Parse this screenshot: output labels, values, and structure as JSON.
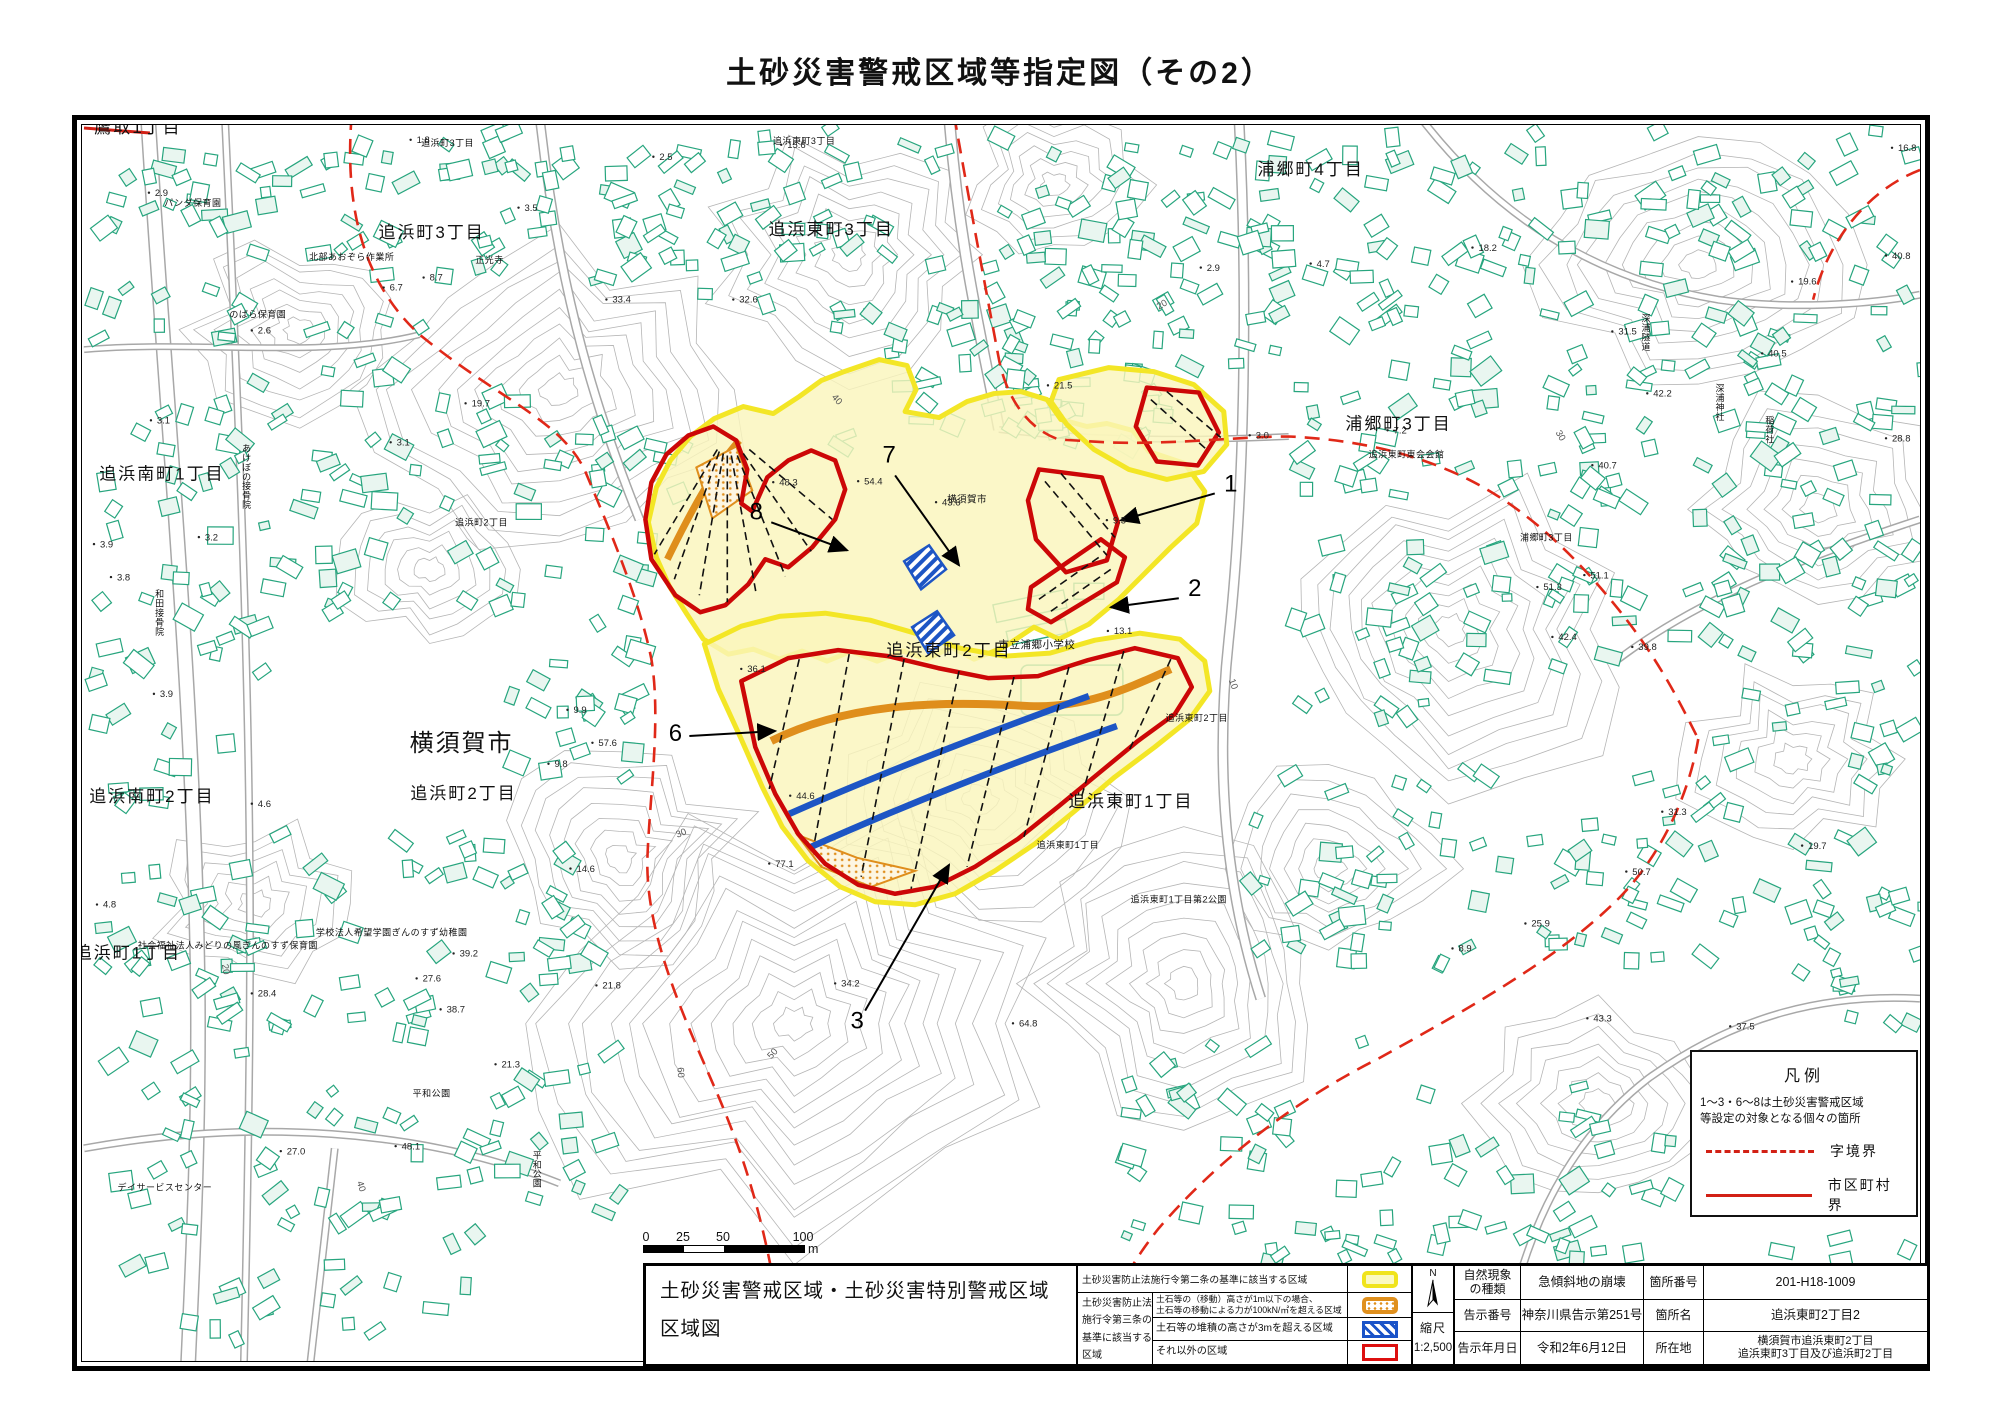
{
  "title": "土砂災害警戒区域等指定図（その2）",
  "legend_box": {
    "title": "凡例",
    "note": "1～3・6～8は土砂災害警戒区域\n等設定の対象となる個々の箇所",
    "items": [
      {
        "style": "dashed",
        "label": "字境界"
      },
      {
        "style": "solid",
        "label": "市区町村界"
      }
    ]
  },
  "scale_bar": {
    "ticks": [
      "0",
      "25",
      "50",
      "100"
    ],
    "unit": "m"
  },
  "info_table": {
    "map_title_line1": "土砂災害警戒区域・土砂災害特別警戒区域",
    "map_title_line2": "区域図",
    "legend_row1": "土砂災害防止法施行令第二条の基準に該当する区域",
    "group_label": "土砂災害防止法\n施行令第三条の\n基準に該当する\n区域",
    "sub_row1": "土石等の（移動）高さが1m以下の場合、\n土石等の移動による力が100kN/㎡を超える区域",
    "sub_row2": "土石等の堆積の高さが3mを超える区域",
    "sub_row3": "それ以外の区域",
    "north_label": "N",
    "scale_label": "縮尺",
    "scale_value": "1:2,500",
    "details": [
      {
        "k": "自然現象\nの種類",
        "v": "急傾斜地の崩壊",
        "k2": "箇所番号",
        "v2": "201-H18-1009"
      },
      {
        "k": "告示番号",
        "v": "神奈川県告示第251号",
        "k2": "箇所名",
        "v2": "追浜東町2丁目2"
      },
      {
        "k": "告示年月日",
        "v": "令和2年6月12日",
        "k2": "所在地",
        "v2": "横須賀市追浜東町2丁目\n追浜東町3丁目及び追浜町2丁目"
      }
    ]
  },
  "colors": {
    "warning_yellow_border": "#f3e626",
    "warning_yellow_fill": "#faf5bc",
    "special_red": "#cc0707",
    "debris_orange": "#df8e1c",
    "deposit_blue": "#1d55c4",
    "building_green": "#27a57e",
    "boundary_red": "#e02818",
    "contour_gray": "#b5b5b5"
  },
  "map": {
    "place_labels": [
      {
        "t": "鷹取1丁目",
        "x": 138,
        "y": 133,
        "s": 17
      },
      {
        "t": "追浜町3丁目",
        "x": 448,
        "y": 146,
        "s": 9
      },
      {
        "t": "追浜町3丁目",
        "x": 432,
        "y": 238,
        "s": 17
      },
      {
        "t": "追浜東町3丁目",
        "x": 805,
        "y": 144,
        "s": 9
      },
      {
        "t": "追浜東町3丁目",
        "x": 832,
        "y": 235,
        "s": 17
      },
      {
        "t": "浦郷町4丁目",
        "x": 1312,
        "y": 175,
        "s": 17
      },
      {
        "t": "浦郷町3丁目",
        "x": 1400,
        "y": 430,
        "s": 17
      },
      {
        "t": "浦郷町3丁目",
        "x": 1548,
        "y": 541,
        "s": 9
      },
      {
        "t": "追浜南町1丁目",
        "x": 162,
        "y": 480,
        "s": 17
      },
      {
        "t": "横須賀市",
        "x": 462,
        "y": 752,
        "s": 24
      },
      {
        "t": "追浜町2丁目",
        "x": 464,
        "y": 800,
        "s": 17
      },
      {
        "t": "追浜南町2丁目",
        "x": 152,
        "y": 803,
        "s": 17
      },
      {
        "t": "追浜東町2丁目",
        "x": 950,
        "y": 657,
        "s": 17
      },
      {
        "t": "追浜東町1丁目",
        "x": 1132,
        "y": 808,
        "s": 17
      },
      {
        "t": "追浜町1丁目",
        "x": 128,
        "y": 960,
        "s": 17
      },
      {
        "t": "市立浦郷小学校",
        "x": 1038,
        "y": 649,
        "s": 10.5
      },
      {
        "t": "横須賀市",
        "x": 968,
        "y": 503,
        "s": 9.5
      },
      {
        "t": "追浜東町2丁目",
        "x": 1198,
        "y": 722,
        "s": 9
      },
      {
        "t": "追浜町2丁目",
        "x": 482,
        "y": 526,
        "s": 9
      },
      {
        "t": "パンダ保育園",
        "x": 193,
        "y": 206,
        "s": 9
      },
      {
        "t": "北部あおぞら作業所",
        "x": 352,
        "y": 260,
        "s": 9
      },
      {
        "t": "正光寺",
        "x": 490,
        "y": 263,
        "s": 9
      },
      {
        "t": "のばら保育園",
        "x": 258,
        "y": 318,
        "s": 9
      },
      {
        "t": "追浜東町東会会館",
        "x": 1408,
        "y": 458,
        "s": 9
      },
      {
        "t": "学校法人希望学園ぎんのすず幼稚園",
        "x": 392,
        "y": 937,
        "s": 9
      },
      {
        "t": "社会福祉法人みどりの風ぎんのすず保育園",
        "x": 228,
        "y": 950,
        "s": 9
      },
      {
        "t": "追浜東町1丁目",
        "x": 1069,
        "y": 849,
        "s": 9
      },
      {
        "t": "追浜東町1丁目第2公園",
        "x": 1180,
        "y": 904,
        "s": 9
      },
      {
        "t": "平和公園",
        "x": 432,
        "y": 1098,
        "s": 9
      },
      {
        "t": "デイサービスセンター",
        "x": 165,
        "y": 1192,
        "s": 9
      },
      {
        "t": "平和公園",
        "x": 538,
        "y": 1160,
        "s": 9,
        "vert": true
      },
      {
        "t": "和田接骨院",
        "x": 160,
        "y": 598,
        "s": 9,
        "vert": true
      },
      {
        "t": "あけぼの接骨院",
        "x": 247,
        "y": 452,
        "s": 9,
        "vert": true
      },
      {
        "t": "深浦隧道",
        "x": 1648,
        "y": 322,
        "s": 9,
        "vert": true
      },
      {
        "t": "深浦神社",
        "x": 1722,
        "y": 392,
        "s": 9,
        "vert": true
      },
      {
        "t": "稲荷社",
        "x": 1772,
        "y": 424,
        "s": 9,
        "vert": true
      }
    ],
    "spot_elevations": [
      {
        "v": "2.5",
        "x": 660,
        "y": 160
      },
      {
        "v": "1.8",
        "x": 417,
        "y": 143
      },
      {
        "v": "2.9",
        "x": 155,
        "y": 196
      },
      {
        "v": "2.6",
        "x": 258,
        "y": 334
      },
      {
        "v": "3.1",
        "x": 157,
        "y": 424
      },
      {
        "v": "3.1",
        "x": 397,
        "y": 446
      },
      {
        "v": "3.2",
        "x": 205,
        "y": 541
      },
      {
        "v": "3.8",
        "x": 117,
        "y": 581
      },
      {
        "v": "3.9",
        "x": 160,
        "y": 698
      },
      {
        "v": "3.9",
        "x": 100,
        "y": 548
      },
      {
        "v": "4.6",
        "x": 258,
        "y": 808
      },
      {
        "v": "4.8",
        "x": 103,
        "y": 909
      },
      {
        "v": "8.7",
        "x": 430,
        "y": 281
      },
      {
        "v": "6.7",
        "x": 390,
        "y": 291
      },
      {
        "v": "3.5",
        "x": 525,
        "y": 211
      },
      {
        "v": "33.4",
        "x": 613,
        "y": 303
      },
      {
        "v": "32.6",
        "x": 740,
        "y": 303
      },
      {
        "v": "15.6",
        "x": 788,
        "y": 148
      },
      {
        "v": "2.9",
        "x": 1208,
        "y": 271
      },
      {
        "v": "4.7",
        "x": 1318,
        "y": 267
      },
      {
        "v": "18.2",
        "x": 1480,
        "y": 251
      },
      {
        "v": "3.0",
        "x": 1257,
        "y": 439
      },
      {
        "v": "7.2",
        "x": 1395,
        "y": 434
      },
      {
        "v": "21.5",
        "x": 1055,
        "y": 389
      },
      {
        "v": "9.5",
        "x": 1114,
        "y": 524
      },
      {
        "v": "48.3",
        "x": 780,
        "y": 486
      },
      {
        "v": "54.4",
        "x": 865,
        "y": 485
      },
      {
        "v": "43.6",
        "x": 943,
        "y": 506
      },
      {
        "v": "36.1",
        "x": 748,
        "y": 673
      },
      {
        "v": "44.6",
        "x": 797,
        "y": 800
      },
      {
        "v": "9.9",
        "x": 574,
        "y": 714
      },
      {
        "v": "9.8",
        "x": 555,
        "y": 768
      },
      {
        "v": "14.6",
        "x": 577,
        "y": 873
      },
      {
        "v": "13.1",
        "x": 1115,
        "y": 635
      },
      {
        "v": "21.8",
        "x": 603,
        "y": 990
      },
      {
        "v": "34.2",
        "x": 842,
        "y": 988
      },
      {
        "v": "64.8",
        "x": 1020,
        "y": 1028
      },
      {
        "v": "77.1",
        "x": 776,
        "y": 868
      },
      {
        "v": "57.6",
        "x": 599,
        "y": 747
      },
      {
        "v": "28.4",
        "x": 258,
        "y": 998
      },
      {
        "v": "27.6",
        "x": 423,
        "y": 983
      },
      {
        "v": "39.2",
        "x": 460,
        "y": 958
      },
      {
        "v": "38.7",
        "x": 447,
        "y": 1014
      },
      {
        "v": "21.3",
        "x": 502,
        "y": 1069
      },
      {
        "v": "27.0",
        "x": 287,
        "y": 1156
      },
      {
        "v": "48.1",
        "x": 402,
        "y": 1151
      },
      {
        "v": "16.8",
        "x": 1900,
        "y": 151
      },
      {
        "v": "40.8",
        "x": 1894,
        "y": 259
      },
      {
        "v": "19.6",
        "x": 1800,
        "y": 285
      },
      {
        "v": "31.5",
        "x": 1620,
        "y": 335
      },
      {
        "v": "40.5",
        "x": 1770,
        "y": 357
      },
      {
        "v": "42.2",
        "x": 1655,
        "y": 397
      },
      {
        "v": "40.7",
        "x": 1600,
        "y": 469
      },
      {
        "v": "28.8",
        "x": 1894,
        "y": 442
      },
      {
        "v": "51.3",
        "x": 1545,
        "y": 591
      },
      {
        "v": "51.1",
        "x": 1592,
        "y": 579
      },
      {
        "v": "42.4",
        "x": 1560,
        "y": 641
      },
      {
        "v": "39.8",
        "x": 1640,
        "y": 651
      },
      {
        "v": "31.3",
        "x": 1670,
        "y": 816
      },
      {
        "v": "50.7",
        "x": 1634,
        "y": 876
      },
      {
        "v": "43.3",
        "x": 1595,
        "y": 1023
      },
      {
        "v": "37.5",
        "x": 1738,
        "y": 1031
      },
      {
        "v": "25.9",
        "x": 1533,
        "y": 928
      },
      {
        "v": "8.9",
        "x": 1460,
        "y": 953
      },
      {
        "v": "19.7",
        "x": 1810,
        "y": 850
      },
      {
        "v": "19.7",
        "x": 472,
        "y": 407
      }
    ],
    "contour_labels": [
      {
        "v": "20",
        "x": 222,
        "y": 966,
        "r": 80
      },
      {
        "v": "40",
        "x": 357,
        "y": 1184,
        "r": 72
      },
      {
        "v": "50",
        "x": 772,
        "y": 1061,
        "r": -48
      },
      {
        "v": "60",
        "x": 678,
        "y": 1069,
        "r": 86
      },
      {
        "v": "30",
        "x": 678,
        "y": 839,
        "r": -22
      },
      {
        "v": "10",
        "x": 1230,
        "y": 681,
        "r": 70
      },
      {
        "v": "30",
        "x": 1557,
        "y": 433,
        "r": 60
      },
      {
        "v": "40",
        "x": 832,
        "y": 398,
        "r": 48
      },
      {
        "v": "20",
        "x": 1160,
        "y": 310,
        "r": -30
      }
    ],
    "site_numbers": [
      {
        "n": "1",
        "tx": 1232,
        "ty": 492,
        "sx": 1216,
        "sy": 494,
        "ax": 1122,
        "ay": 521
      },
      {
        "n": "2",
        "tx": 1196,
        "ty": 597,
        "sx": 1180,
        "sy": 599,
        "ax": 1112,
        "ay": 608
      },
      {
        "n": "3",
        "tx": 858,
        "ty": 1030,
        "sx": 866,
        "sy": 1012,
        "ax": 950,
        "ay": 866
      },
      {
        "n": "6",
        "tx": 676,
        "ty": 742,
        "sx": 690,
        "sy": 737,
        "ax": 776,
        "ay": 732
      },
      {
        "n": "7",
        "tx": 890,
        "ty": 463,
        "sx": 896,
        "sy": 476,
        "ax": 960,
        "ay": 566
      },
      {
        "n": "8",
        "tx": 757,
        "ty": 520,
        "sx": 772,
        "sy": 523,
        "ax": 848,
        "ay": 551
      }
    ]
  }
}
